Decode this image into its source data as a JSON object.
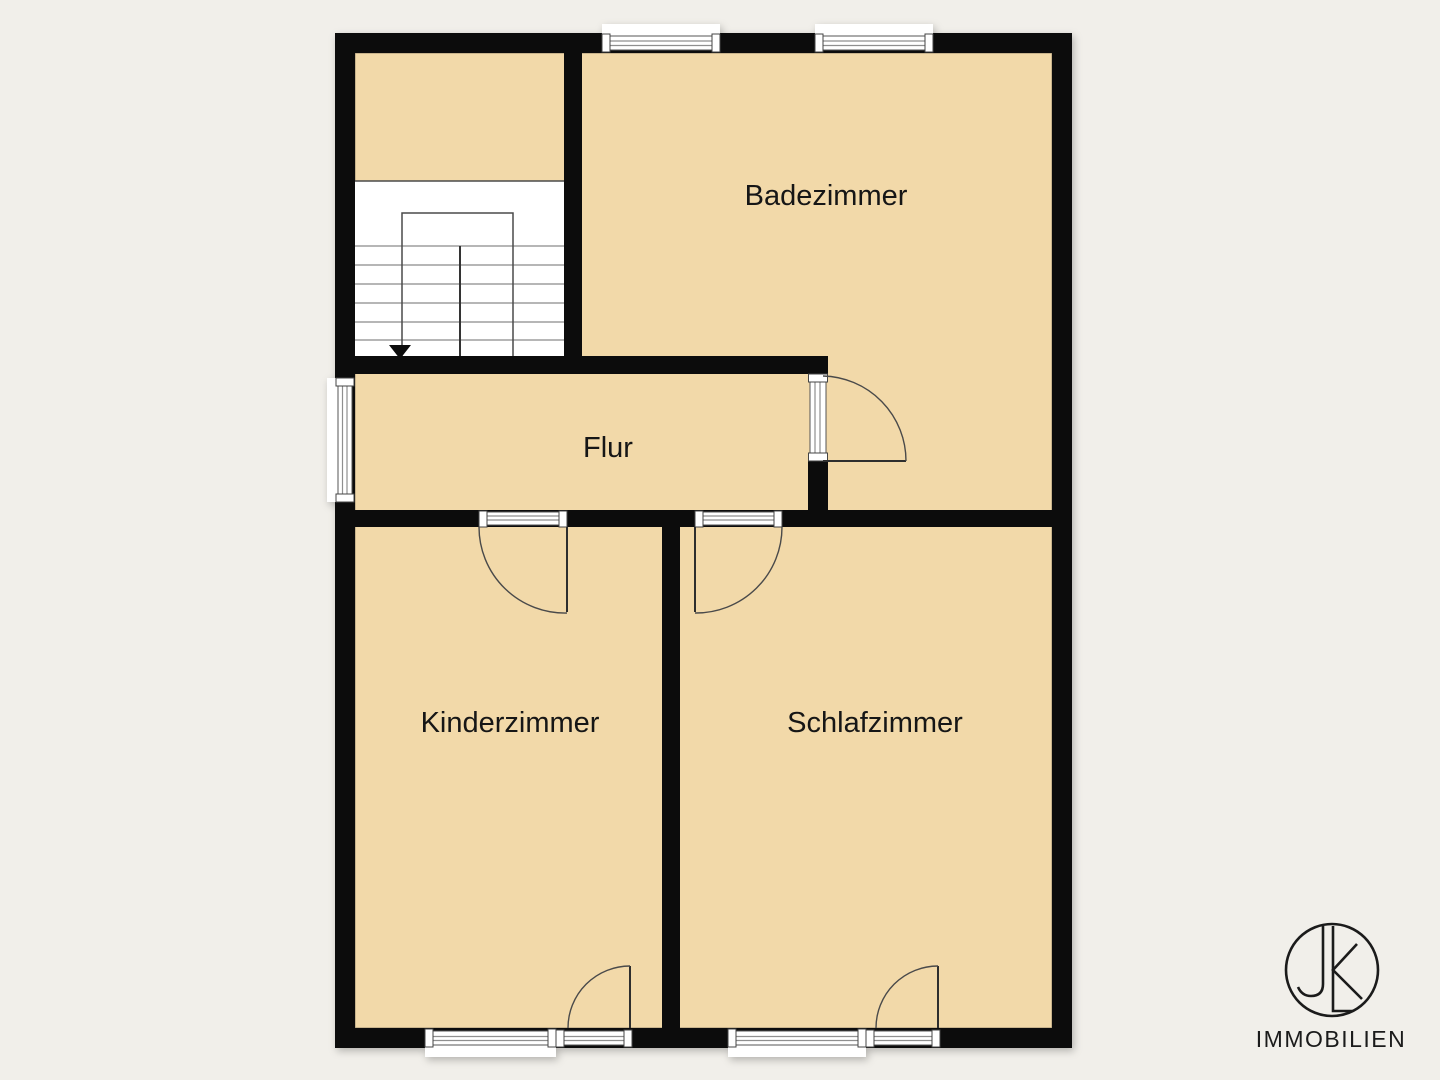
{
  "colors": {
    "bg": "#f1efea",
    "floor": "#f2d9a9",
    "wall": "#0c0c0c",
    "line": "#2e2e2e",
    "stairline": "#8a8a8a",
    "winline": "#8f8f8f",
    "text": "#161616",
    "logo": "#1b1b1b"
  },
  "plan": {
    "type": "floor-plan",
    "rooms": [
      {
        "name": "Badezimmer"
      },
      {
        "name": "Flur"
      },
      {
        "name": "Kinderzimmer"
      },
      {
        "name": "Schlafzimmer"
      }
    ],
    "features": {
      "staircase": "stairs-down-arrow",
      "windows": 5,
      "doors": 5
    }
  },
  "logo": {
    "monogram": "JK",
    "text": "IMMOBILIEN"
  }
}
